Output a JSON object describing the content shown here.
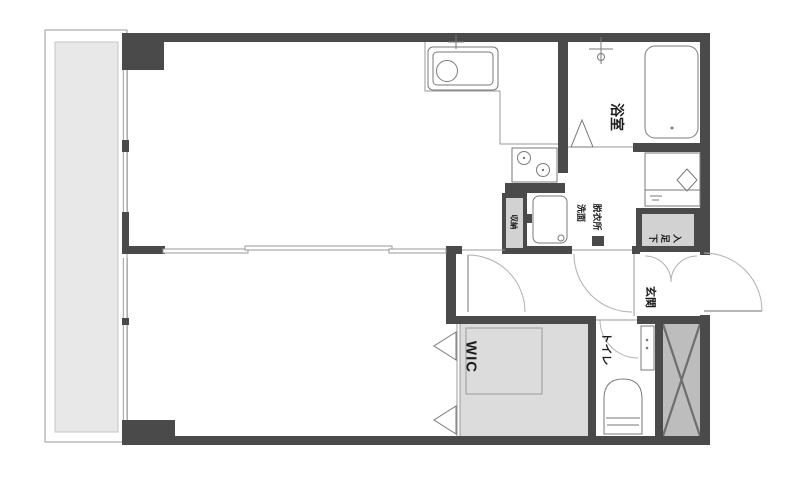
{
  "plan_title": "",
  "colors": {
    "wall": "#4a4a4a",
    "line": "#9a9a9a",
    "balcony_fill": "#e8e8e8",
    "closet_fill": "#d2d2d2",
    "shaft_fill": "#bdbdbd",
    "background": "#ffffff",
    "text": "#1c1c1c"
  },
  "rooms": {
    "bathroom": {
      "label": "浴室"
    },
    "washroom": {
      "label_line1": "洗面",
      "label_line2": "脱衣所"
    },
    "toilet": {
      "label": "トイレ"
    },
    "entrance": {
      "label": "玄関"
    },
    "wic": {
      "label": "WIC"
    },
    "shoe_cabinet": {
      "label": "下足入"
    },
    "storage": {
      "label": "収納"
    }
  },
  "fixtures": [
    "kitchen-sink-icon",
    "faucet-icon",
    "gas-stove-icon",
    "bathtub-icon",
    "shower-faucet-icon",
    "vanity-sink-icon",
    "washing-machine-pan-icon",
    "toilet-bowl-icon",
    "pipe-shaft-cross-icon",
    "folding-door-icon",
    "door-swing-arc-icon",
    "sliding-partition-icon",
    "window-icon"
  ]
}
